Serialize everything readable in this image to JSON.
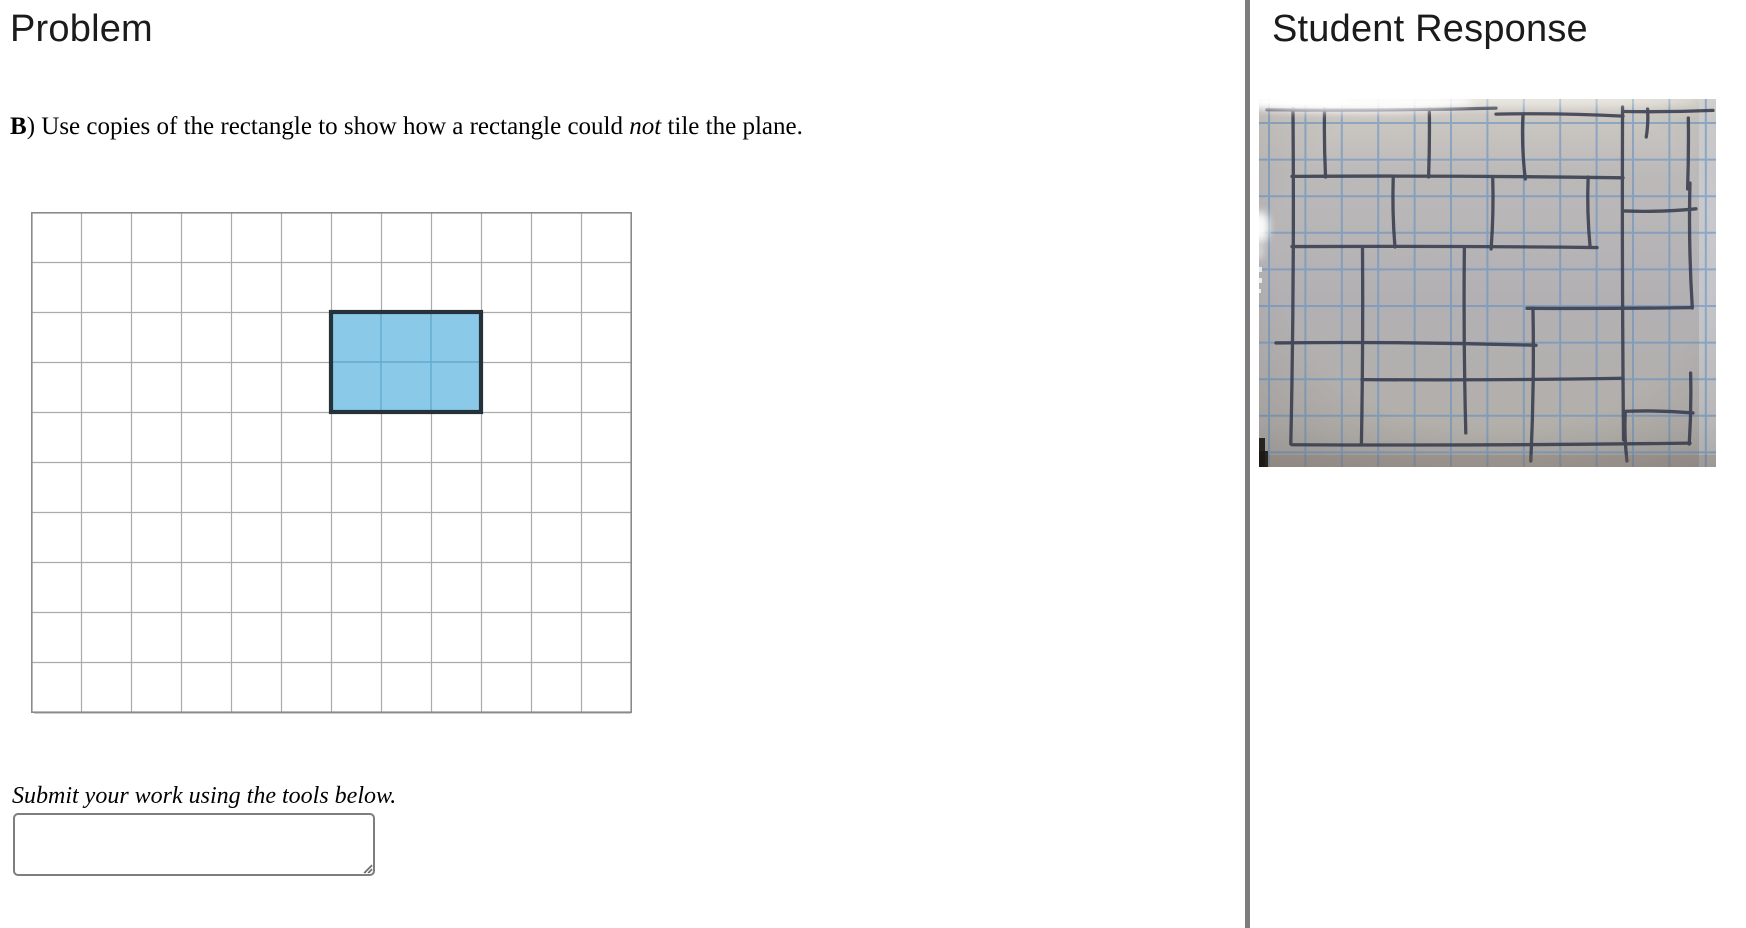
{
  "left_panel": {
    "title": "Problem",
    "question": {
      "parts": [
        {
          "text": "B",
          "style": "bold"
        },
        {
          "text": ") Use copies of the rectangle to show how a rectangle could ",
          "style": "normal"
        },
        {
          "text": "not",
          "style": "italic"
        },
        {
          "text": " tile the plane.",
          "style": "normal"
        }
      ]
    },
    "grid": {
      "columns": 12,
      "rows": 10,
      "cell_size": 50,
      "line_color": "#ababab",
      "border_color": "#8a8a8a",
      "highlight_rect": {
        "col": 6,
        "row": 2,
        "col_span": 3,
        "row_span": 2,
        "fill": "#8bc9e8",
        "inner_line_color": "#62abd0",
        "border_color": "#25323a"
      }
    },
    "instruction": "Submit your work using the tools below.",
    "answer_box": {
      "value": "",
      "placeholder": ""
    }
  },
  "right_panel": {
    "title": "Student Response",
    "photo": {
      "description": "Photo of blue graph paper with hand-drawn staggered rectangles tiling the plane, light glare at top-left and left edge",
      "paper_color": "#b4b1b1",
      "graph_line_color": "#5d8ec1",
      "ink_color": "#383d4e",
      "graph_spacing_x": 36.4,
      "graph_spacing_y": 36.6,
      "h_strokes": [
        [
          10,
          8,
          237
        ],
        [
          16,
          237,
          364
        ],
        [
          12,
          364,
          454
        ],
        [
          78,
          33,
          364
        ],
        [
          111,
          364,
          437
        ],
        [
          148,
          33,
          338
        ],
        [
          209,
          268,
          433
        ],
        [
          245,
          17,
          277
        ],
        [
          280,
          103,
          364
        ],
        [
          313,
          367,
          434
        ],
        [
          345,
          33,
          431
        ]
      ],
      "v_strokes": [
        [
          33,
          10,
          345
        ],
        [
          66,
          10,
          78
        ],
        [
          170,
          10,
          78
        ],
        [
          265,
          16,
          80
        ],
        [
          388,
          10,
          38
        ],
        [
          135,
          78,
          148
        ],
        [
          233,
          78,
          150
        ],
        [
          330,
          78,
          148
        ],
        [
          103,
          148,
          345
        ],
        [
          206,
          149,
          334
        ],
        [
          273,
          209,
          362
        ],
        [
          364,
          8,
          341
        ],
        [
          429,
          19,
          90
        ],
        [
          432,
          84,
          209
        ],
        [
          431,
          274,
          345
        ],
        [
          367,
          313,
          362
        ]
      ]
    }
  },
  "divider_color": "#7d7d7d"
}
